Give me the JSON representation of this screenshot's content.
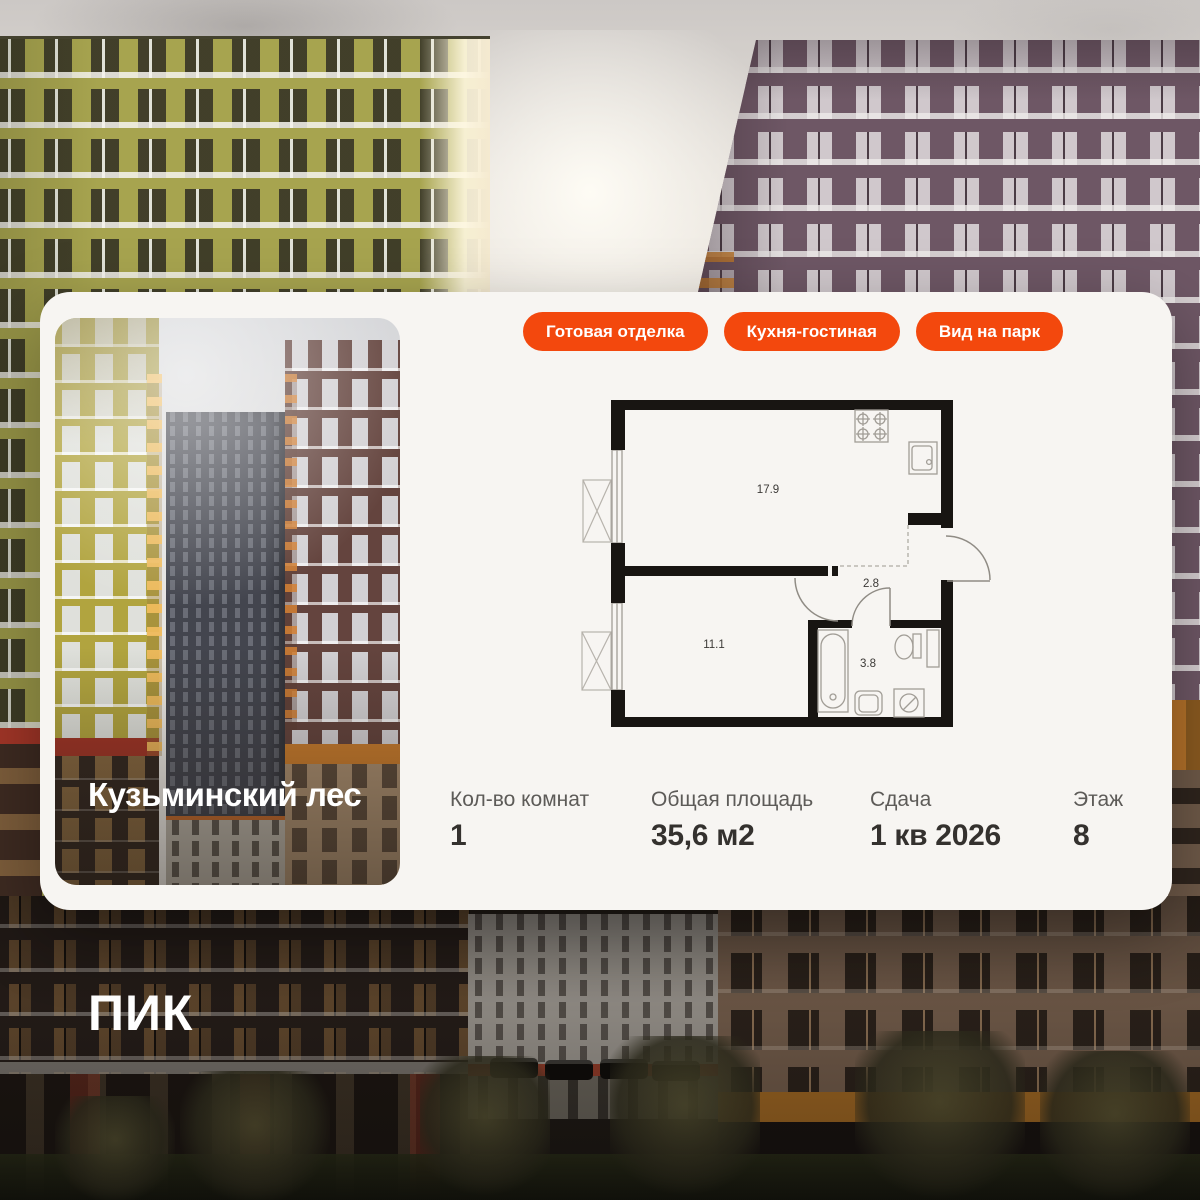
{
  "brand": {
    "logo_text": "ПИК"
  },
  "card": {
    "project_title": "Кузьминский лес",
    "badges": [
      {
        "label": "Готовая отделка"
      },
      {
        "label": "Кухня-гостиная"
      },
      {
        "label": "Вид на парк"
      }
    ],
    "stats": [
      {
        "label": "Кол-во комнат",
        "value": "1"
      },
      {
        "label": "Общая площадь",
        "value": "35,6 м2"
      },
      {
        "label": "Сдача",
        "value": "1 кв 2026"
      },
      {
        "label": "Этаж",
        "value": "8"
      }
    ],
    "floor_plan": {
      "rooms": [
        {
          "name": "кухня-гостиная",
          "area": "17.9"
        },
        {
          "name": "спальня",
          "area": "11.1"
        },
        {
          "name": "прихожая",
          "area": "2.8"
        },
        {
          "name": "санузел",
          "area": "3.8"
        }
      ]
    }
  },
  "colors": {
    "accent_orange": "#f3480d",
    "card_bg": "#f7f5f2",
    "plan_wall": "#181512",
    "stat_value": "#34312e",
    "stat_label": "#5d5b58"
  }
}
